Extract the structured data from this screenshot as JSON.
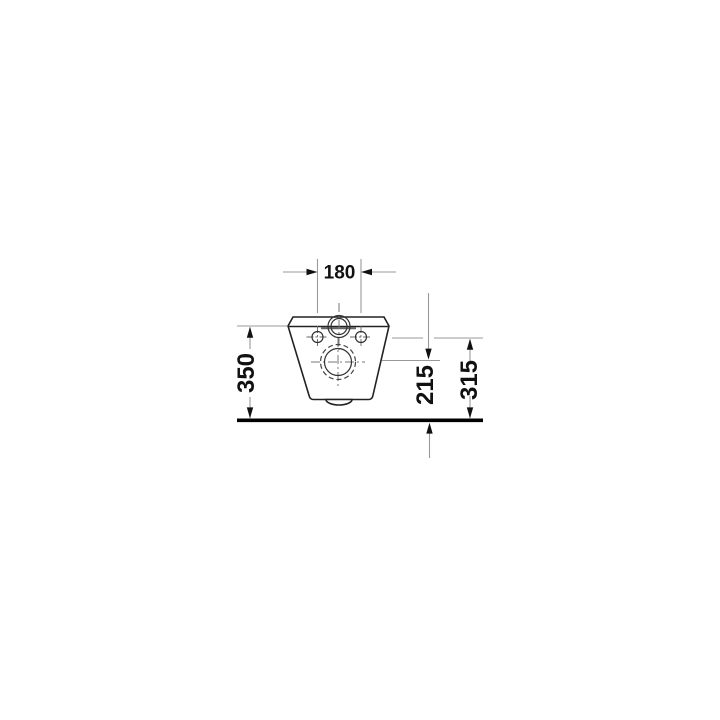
{
  "drawing": {
    "kind": "technical-dimension-drawing",
    "subject": "wall-hung-toilet-rear-view",
    "dimensions": {
      "hole_spacing": {
        "label": "180"
      },
      "overall_height": {
        "label": "350"
      },
      "outlet_height": {
        "label": "215"
      },
      "hole_height": {
        "label": "315"
      }
    },
    "colors": {
      "background": "#ffffff",
      "outline": "#222222",
      "dimension_lines": "#999999",
      "text_and_arrows": "#111111",
      "floor_line": "#000000"
    }
  }
}
